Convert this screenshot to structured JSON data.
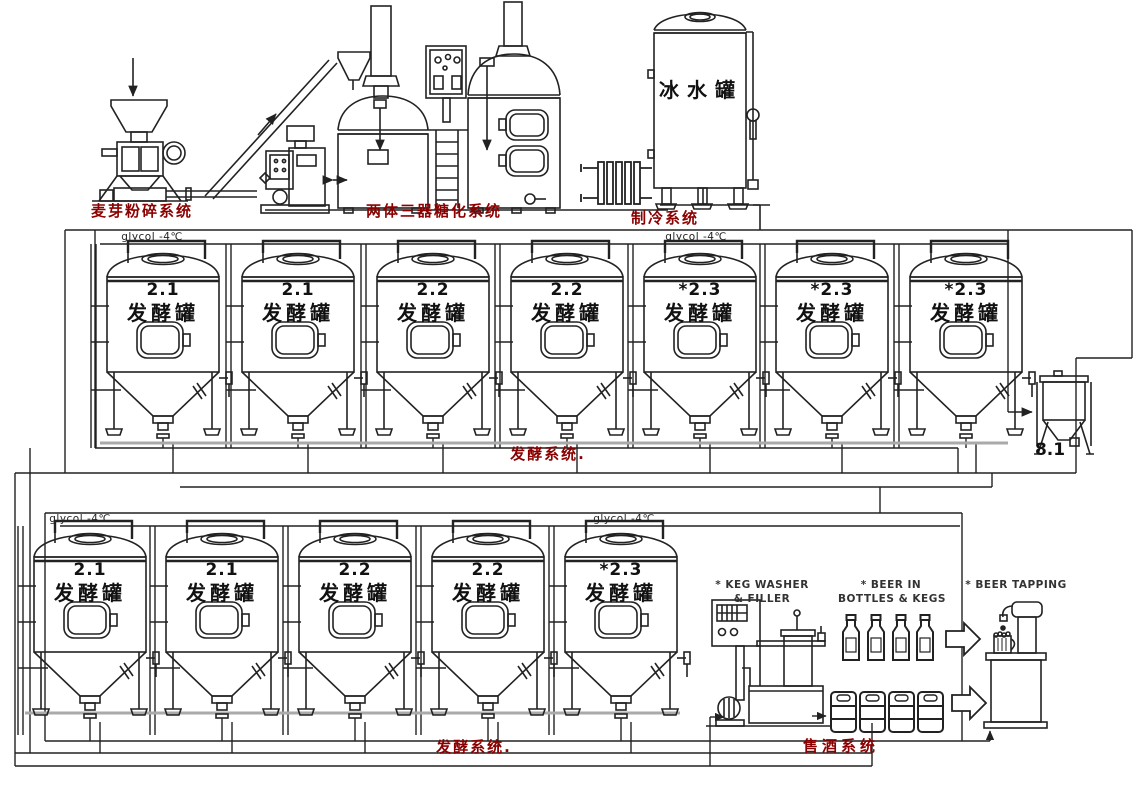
{
  "colors": {
    "accent_red": "#8B0000",
    "line": "#222222",
    "text_black": "#111111"
  },
  "labels": {
    "malt_mill": "麦芽粉碎系统",
    "brewhouse": "两体三器糖化系统",
    "refrigeration": "制冷系统",
    "ice_water_tank": "冰水罐",
    "fermentation_row1": "发酵系统.",
    "fermentation_row2": "发酵系统.",
    "beer_sales": "售酒系统",
    "glycol": "glycol -4℃",
    "yeast_tank": "8.1",
    "keg_washer_line1": "* KEG WASHER",
    "keg_washer_line2": "& FILLER",
    "beer_in_line1": "* BEER IN",
    "beer_in_line2": "BOTTLES & KEGS",
    "beer_tapping": "* BEER TAPPING"
  },
  "fermenters": {
    "row1": [
      {
        "number": "2.1",
        "name": "发酵罐"
      },
      {
        "number": "2.1",
        "name": "发酵罐"
      },
      {
        "number": "2.2",
        "name": "发酵罐"
      },
      {
        "number": "2.2",
        "name": "发酵罐"
      },
      {
        "number": "*2.3",
        "name": "发酵罐"
      },
      {
        "number": "*2.3",
        "name": "发酵罐"
      },
      {
        "number": "*2.3",
        "name": "发酵罐"
      }
    ],
    "row2": [
      {
        "number": "2.1",
        "name": "发酵罐"
      },
      {
        "number": "2.1",
        "name": "发酵罐"
      },
      {
        "number": "2.2",
        "name": "发酵罐"
      },
      {
        "number": "2.2",
        "name": "发酵罐"
      },
      {
        "number": "*2.3",
        "name": "发酵罐"
      }
    ]
  }
}
